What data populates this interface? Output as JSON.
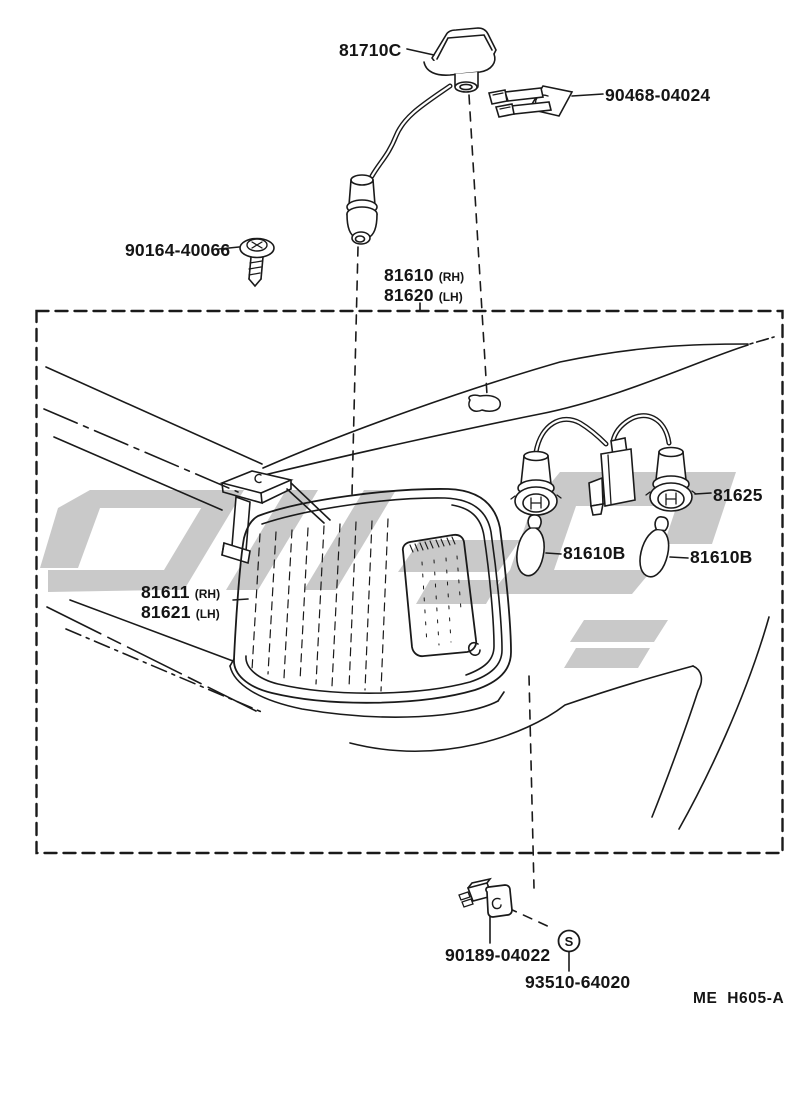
{
  "colors": {
    "ink": "#1a1a1a",
    "watermark": "#c9c9c9",
    "background": "#ffffff"
  },
  "labels": {
    "marker_lamp": "81710C",
    "clip": "90468-04024",
    "screw": "90164-40066",
    "lamp_assy_rh": "81610",
    "lamp_assy_rh_side": "(RH)",
    "lamp_assy_lh": "81620",
    "lamp_assy_lh_side": "(LH)",
    "lens_rh": "81611",
    "lens_rh_side": "(RH)",
    "lens_lh": "81621",
    "lens_lh_side": "(LH)",
    "socket": "81625",
    "bulb_left": "81610B",
    "bulb_right": "81610B",
    "retainer": "90189-04022",
    "screw_set": "93510-64020",
    "s_symbol": "S"
  },
  "footer": {
    "code": "ME  H605-A"
  }
}
